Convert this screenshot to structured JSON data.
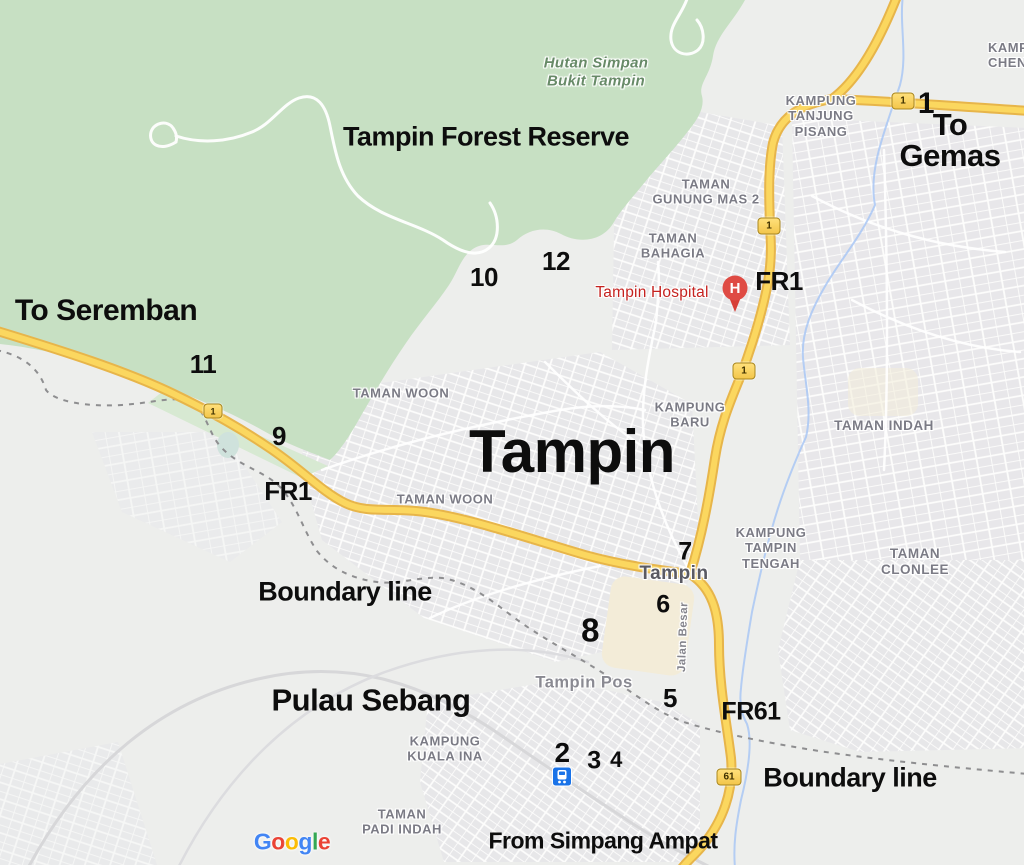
{
  "map_title": "Tampin / Pulau Sebang annotated route map",
  "colors": {
    "forest_green": "#c7e0c3",
    "forest_light": "#d7e9d2",
    "land_gray": "#edeeec",
    "urban_gray": "#e6e5e9",
    "road_fill": "#fbd75f",
    "road_casing": "#e7b54a",
    "river_blue": "#a9c7f4",
    "boundary_dash": "#8e8e90",
    "annotation_black": "#0d0d0d",
    "place_label_gray": "#7b7b85",
    "hospital_red": "#c5221f",
    "station_blue": "#1a73e8",
    "shield_yellow": "#f3c64b"
  },
  "annotations": {
    "forest_title": "Tampin Forest Reserve",
    "to_seremban": "To Seremban",
    "to_gemas": "To Gemas",
    "from_simpang_ampat": "From Simpang Ampat",
    "boundary_line_left": "Boundary line",
    "boundary_line_right": "Boundary line",
    "pulau_sebang": "Pulau Sebang",
    "tampin_big": "Tampin",
    "fr1_left": "FR1",
    "fr1_right": "FR1",
    "fr61": "FR61",
    "numbers": {
      "n1": "1",
      "n2": "2",
      "n3": "3",
      "n4": "4",
      "n5": "5",
      "n6": "6",
      "n7": "7",
      "n8": "8",
      "n9": "9",
      "n10": "10",
      "n11": "11",
      "n12": "12"
    }
  },
  "labels": {
    "hutan_simpan": "Hutan Simpan\nBukit Tampin",
    "kampung_tanjung_pisang": "KAMPUNG\nTANJUNG\nPISANG",
    "kampung_chen": "KAMP\nCHEN",
    "taman_gunung_mas": "TAMAN\nGUNUNG MAS 2",
    "taman_bahagia": "TAMAN\nBAHAGIA",
    "tampin_hospital": "Tampin Hospital",
    "taman_woon_north": "TAMAN WOON",
    "taman_woon_south": "TAMAN WOON",
    "kampung_baru": "KAMPUNG\nBARU",
    "taman_indah": "TAMAN INDAH",
    "kampung_tampin_tengah": "KAMPUNG\nTAMPIN\nTENGAH",
    "taman_clonlee": "TAMAN CLONLEE",
    "tampin_town": "Tampin",
    "jalan_besar": "Jalan Besar",
    "tampin_pos": "Tampin Pos",
    "kampung_kuala_ina": "KAMPUNG\nKUALA INA",
    "taman_padi_indah": "TAMAN\nPADI INDAH"
  },
  "shields": {
    "route1": "1",
    "route61": "61"
  },
  "markers": {
    "hospital_letter": "H"
  },
  "attribution": {
    "letters": [
      "G",
      "o",
      "o",
      "g",
      "l",
      "e"
    ]
  }
}
